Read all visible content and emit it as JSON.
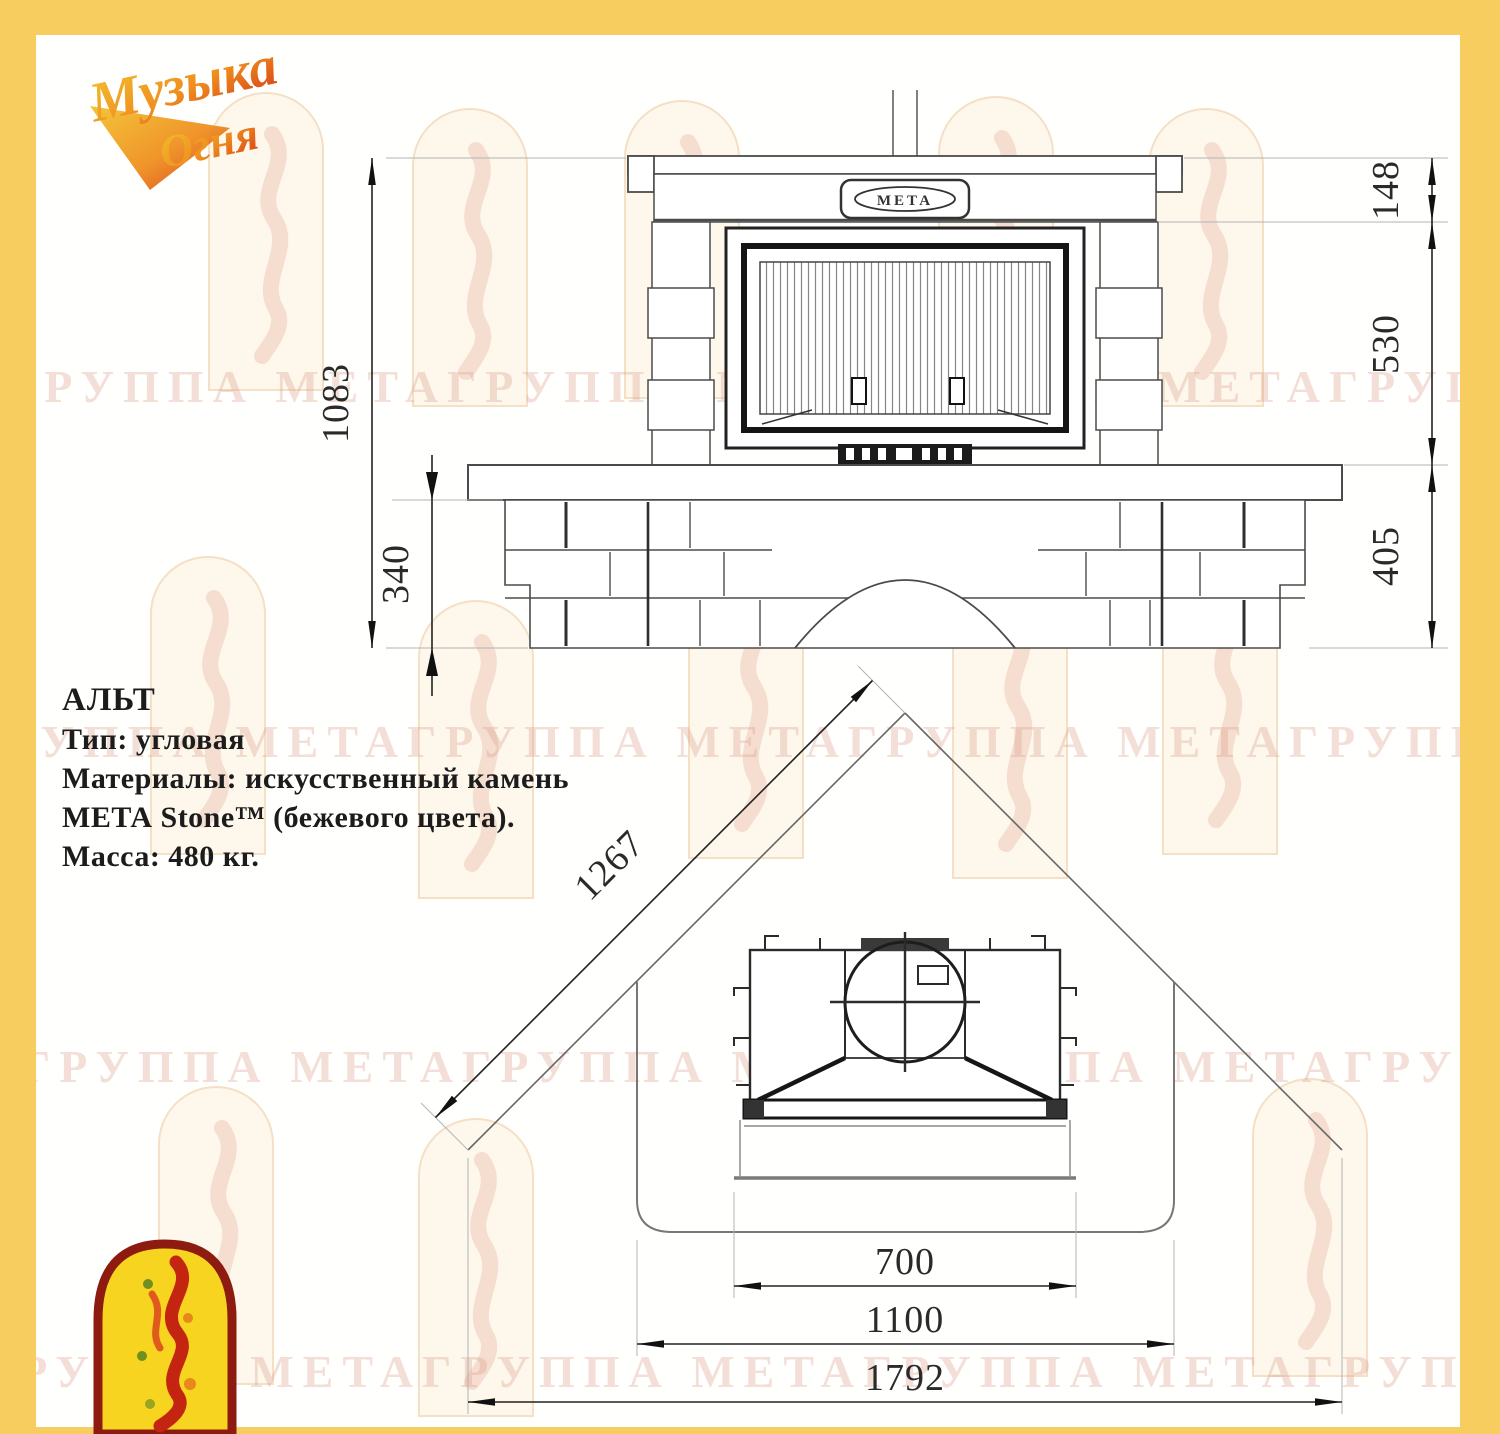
{
  "brand": {
    "logo_line1": "Музыка",
    "logo_line2": "Огня"
  },
  "watermark": {
    "row_text": "ГРУППА МЕТАГРУППА МЕТАГРУППА МЕТАГРУППА МЕТАГРУППА МЕТА"
  },
  "specs": {
    "model": "АЛЬТ",
    "type_line": "Тип: угловая",
    "material_line1": "Материалы: искусственный камень",
    "material_line2": "МЕТА Stone™ (бежевого цвета).",
    "mass_line": "Масса: 480 кг."
  },
  "front_view": {
    "plate_label": "МЕТА",
    "dims": {
      "total_height": "1083",
      "plinth_height": "340",
      "mantel_height": "148",
      "firebox_height": "530",
      "bench_height": "405"
    }
  },
  "plan_view": {
    "dims": {
      "wall_side": "1267",
      "opening_width": "700",
      "hearth_width": "1100",
      "overall_width": "1792"
    }
  }
}
